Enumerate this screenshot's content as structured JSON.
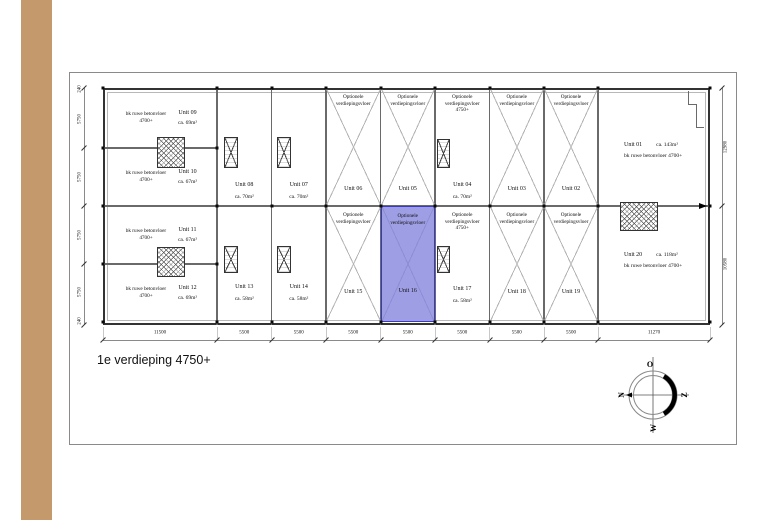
{
  "title": "1e verdieping 4750+",
  "colors": {
    "highlight_fill": "#9e9ee4",
    "highlight_border": "#3a3ac0",
    "stripe_tan": "#c49a6c"
  },
  "labels": {
    "raw_floor": "bk ruwe betonvloer 4700+",
    "optional_floor": "Optionele verdiepingsvloer",
    "optional_floor_4750": "Optionele verdiepingsvloer 4750+"
  },
  "units": {
    "01": {
      "name": "Unit 01",
      "area": "ca. 143m²",
      "floor": "bk ruwe betonvloer 4700+"
    },
    "02": {
      "name": "Unit 02",
      "note": "Optionele verdiepingsvloer"
    },
    "03": {
      "name": "Unit 03",
      "note": "Optionele verdiepingsvloer"
    },
    "04": {
      "name": "Unit 04",
      "area": "ca. 70m²",
      "note": "Optionele verdiepingsvloer 4750+"
    },
    "05": {
      "name": "Unit 05",
      "note": "Optionele verdiepingsvloer"
    },
    "06": {
      "name": "Unit 06",
      "note": "Optionele verdiepingsvloer"
    },
    "07": {
      "name": "Unit 07",
      "area": "ca. 70m²"
    },
    "08": {
      "name": "Unit 08",
      "area": "ca. 70m²"
    },
    "09": {
      "name": "Unit 09",
      "area": "ca. 69m²",
      "floor": "bk ruwe betonvloer 4700+"
    },
    "10": {
      "name": "Unit 10",
      "area": "ca. 67m²",
      "floor": "bk ruwe betonvloer 4700+"
    },
    "11": {
      "name": "Unit 11",
      "area": "ca. 67m²",
      "floor": "bk ruwe betonvloer 4700+"
    },
    "12": {
      "name": "Unit 12",
      "area": "ca. 69m²",
      "floor": "bk ruwe betonvloer 4700+"
    },
    "13": {
      "name": "Unit 13",
      "area": "ca. 58m²"
    },
    "14": {
      "name": "Unit 14",
      "area": "ca. 58m²"
    },
    "15": {
      "name": "Unit 15",
      "note": "Optionele verdiepingsvloer"
    },
    "16": {
      "name": "Unit 16",
      "note": "Optionele verdiepingsvloer",
      "selected": true
    },
    "17": {
      "name": "Unit 17",
      "area": "ca. 58m²",
      "note": "Optionele verdiepingsvloer 4750+"
    },
    "18": {
      "name": "Unit 18",
      "note": "Optionele verdiepingsvloer"
    },
    "19": {
      "name": "Unit 19",
      "note": "Optionele verdiepingsvloer"
    },
    "20": {
      "name": "Unit 20",
      "area": "ca. 118m²",
      "floor": "bk ruwe betonvloer 4700+"
    }
  },
  "dimensions": {
    "bottom": [
      "11500",
      "5500",
      "5500",
      "5500",
      "5500",
      "5500",
      "5500",
      "5500",
      "11270"
    ],
    "left": [
      "240",
      "5750",
      "5750",
      "5750",
      "5750",
      "240"
    ],
    "right": [
      "12980",
      "10580"
    ]
  },
  "compass": {
    "top": "O",
    "right": "Z",
    "bottom": "W",
    "left": "N"
  }
}
